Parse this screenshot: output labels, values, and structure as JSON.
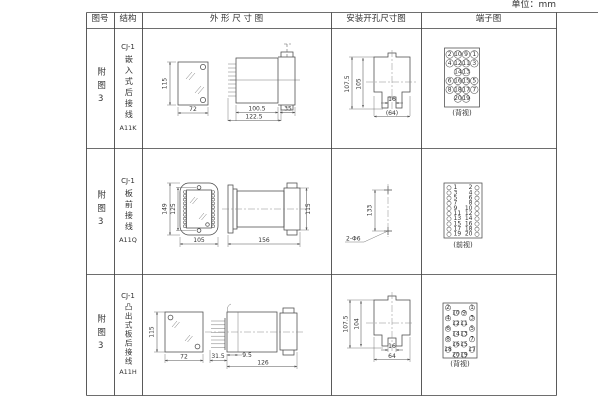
{
  "unit_label": "单位：mm",
  "header": {
    "col_fig": "图号",
    "col_structure": "结构",
    "col_outline": "外 形 尺 寸 图",
    "col_hole": "安装开孔尺寸图",
    "col_terminal": "端子图"
  },
  "rows": [
    {
      "fig": "附图3",
      "series": "CJ-1",
      "structure": "嵌入式后接线",
      "model": "A11K",
      "outline": {
        "height": "115",
        "width": "72",
        "body": "100.5",
        "overall": "122.5",
        "flange": "35"
      },
      "hole": {
        "h_outer": "107.5",
        "h_inner": "105",
        "slot": "16",
        "width": "(64)"
      },
      "terminal": {
        "view": "(背视)",
        "grid": [
          [
            2,
            10,
            9,
            1
          ],
          [
            4,
            12,
            11,
            3
          ],
          [
            null,
            14,
            13,
            null
          ],
          [
            6,
            16,
            15,
            5
          ],
          [
            8,
            18,
            17,
            7
          ],
          [
            null,
            20,
            19,
            null
          ]
        ]
      }
    },
    {
      "fig": "附图3",
      "series": "CJ-1",
      "structure": "板前接线",
      "model": "A11Q",
      "outline": {
        "outer_height": "149",
        "inner_height": "125",
        "width": "105",
        "length": "156",
        "side_height": "115"
      },
      "hole": {
        "spacing": "133",
        "holes": "2-Φ6"
      },
      "terminal": {
        "view": "(前视)",
        "left": [
          1,
          3,
          5,
          7,
          9,
          11,
          13,
          15,
          17,
          19
        ],
        "right": [
          2,
          4,
          6,
          8,
          10,
          12,
          14,
          16,
          18,
          20
        ]
      }
    },
    {
      "fig": "附图3",
      "series": "CJ-1",
      "structure": "凸出式板后接线",
      "model": "A11H",
      "outline": {
        "height": "115",
        "width": "72",
        "offset": "31.5",
        "inset": "9.5",
        "length": "126"
      },
      "hole": {
        "h_outer": "107.5",
        "h_inner": "104",
        "slot": "16",
        "width": "64"
      },
      "terminal": {
        "view": "(背视)",
        "left": [
          2,
          10,
          4,
          12,
          6,
          14,
          8,
          16,
          18,
          20
        ],
        "right": [
          1,
          9,
          3,
          11,
          5,
          13,
          7,
          15,
          17,
          19
        ]
      }
    }
  ]
}
